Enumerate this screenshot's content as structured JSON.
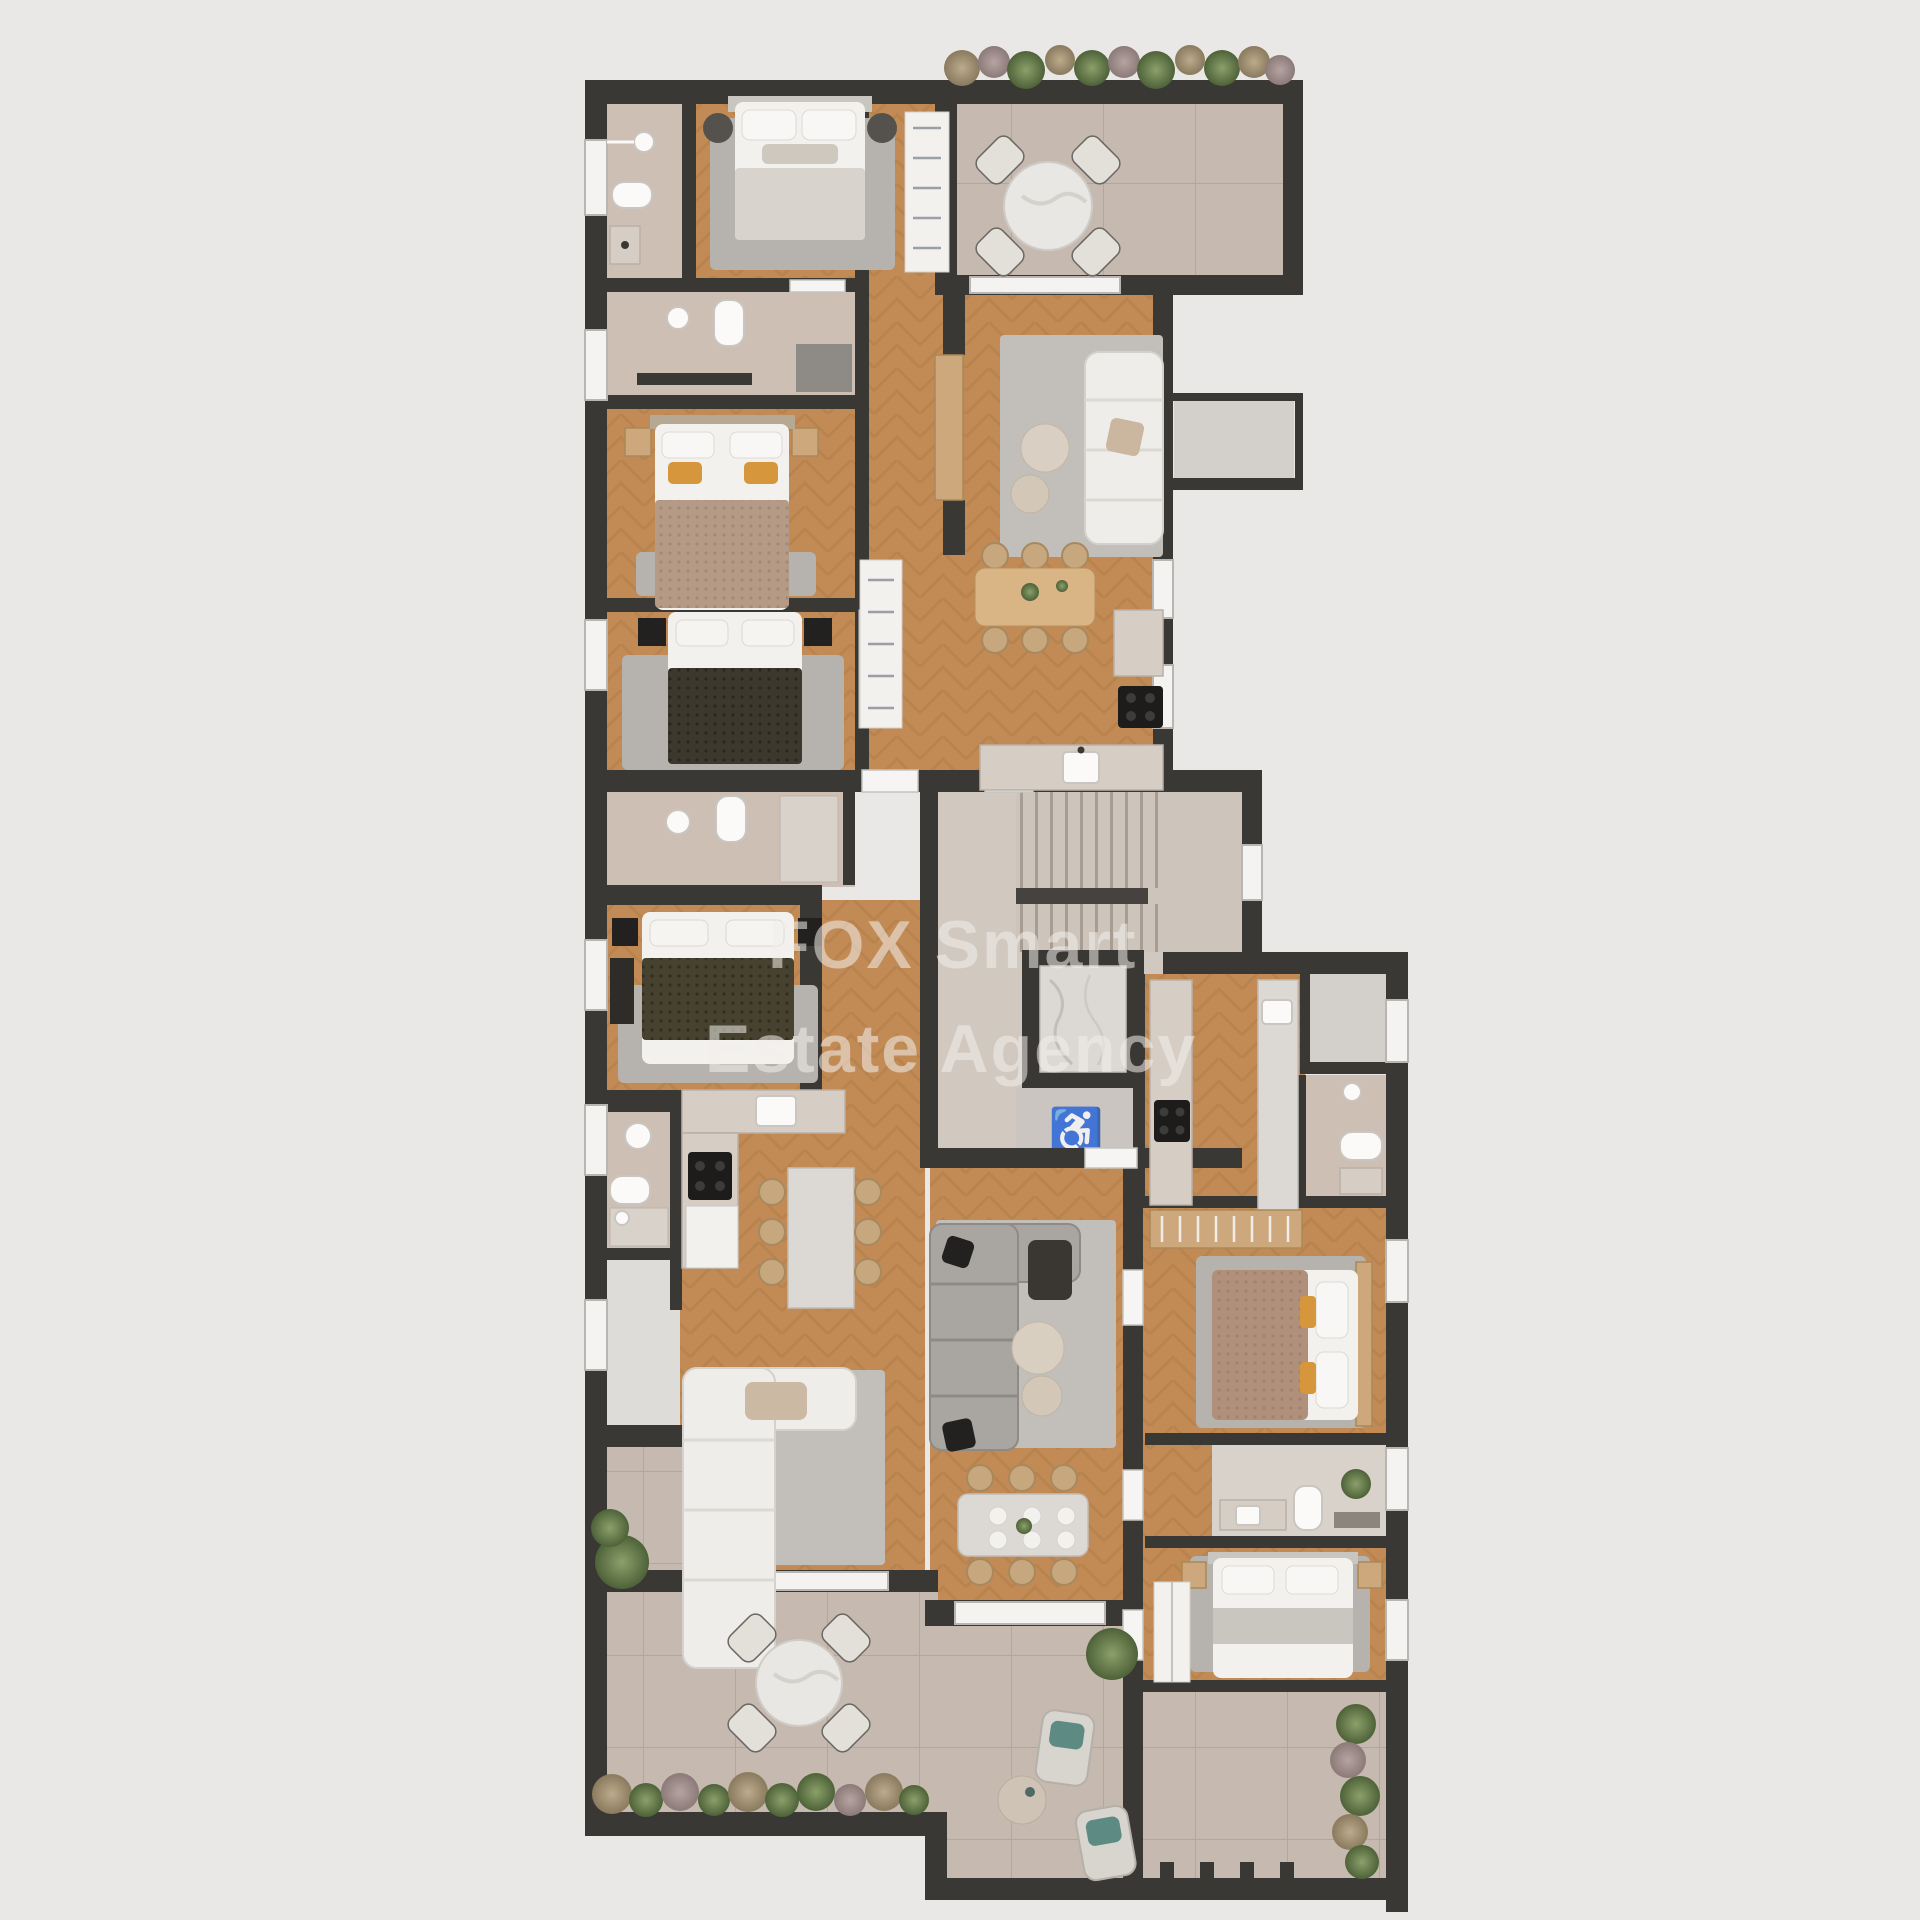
{
  "watermark": {
    "line1": "FOX Smart",
    "line2": "Estate Agency",
    "color": "#f2efeb",
    "opacity": "0.55"
  },
  "icons": {
    "wheelchair": "♿"
  },
  "palette": {
    "bg": "#e9e8e6",
    "wall": "#3a3835",
    "wood1": "#c28b56",
    "wood2": "#a9773f",
    "tile": "#cdbfb3",
    "terrace": "#c6bab0",
    "terraceLine": "#b3a79c",
    "lobby": "#d1c8bf",
    "stair": "#cdc5bb",
    "stairLine": "#a79d92",
    "slab": "#454240",
    "marble": "#dcd9d5",
    "balcony": "#d3d0cb",
    "storage": "#dedcd9",
    "counter": "#d6cec5",
    "rug": "#b6b2ad",
    "rugLight": "#c2beb9",
    "sofaGray": "#a9a5a0",
    "woodFurn": "#cda87c",
    "rattan": "#c7a77d",
    "accent": "#d6973c",
    "teal": "#5e8a84",
    "darkBed": "#3c382e",
    "tanBed": "#b0907a",
    "green1": "#5f7747",
    "green2": "#7e9059",
    "green3": "#4e6239",
    "dry1": "#a89a7c",
    "dry2": "#a3908f"
  }
}
